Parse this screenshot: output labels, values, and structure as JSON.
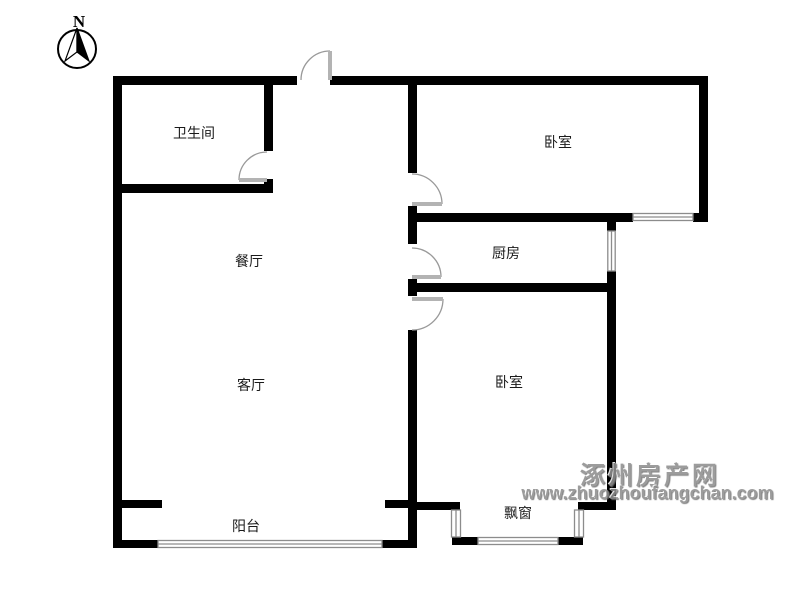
{
  "compass": {
    "label": "N"
  },
  "rooms": [
    {
      "id": "bathroom",
      "label": "卫生间"
    },
    {
      "id": "bedroom-top",
      "label": "卧室"
    },
    {
      "id": "dining-room",
      "label": "餐厅"
    },
    {
      "id": "kitchen",
      "label": "厨房"
    },
    {
      "id": "living-room",
      "label": "客厅"
    },
    {
      "id": "bedroom-bottom",
      "label": "卧室"
    },
    {
      "id": "balcony",
      "label": "阳台"
    },
    {
      "id": "bay-window",
      "label": "飘窗"
    }
  ],
  "watermark": {
    "site_name": "涿州房产网",
    "site_url": "www.zhuozhoufangchan.com"
  },
  "colors": {
    "wall": "#000000",
    "window_frame": "#8c8c8c",
    "door_leaf": "#b3b3b3",
    "door_arc": "#999999",
    "watermark_gray": "#8f8f8f",
    "background": "#ffffff",
    "label_text": "#1a1a1a"
  }
}
